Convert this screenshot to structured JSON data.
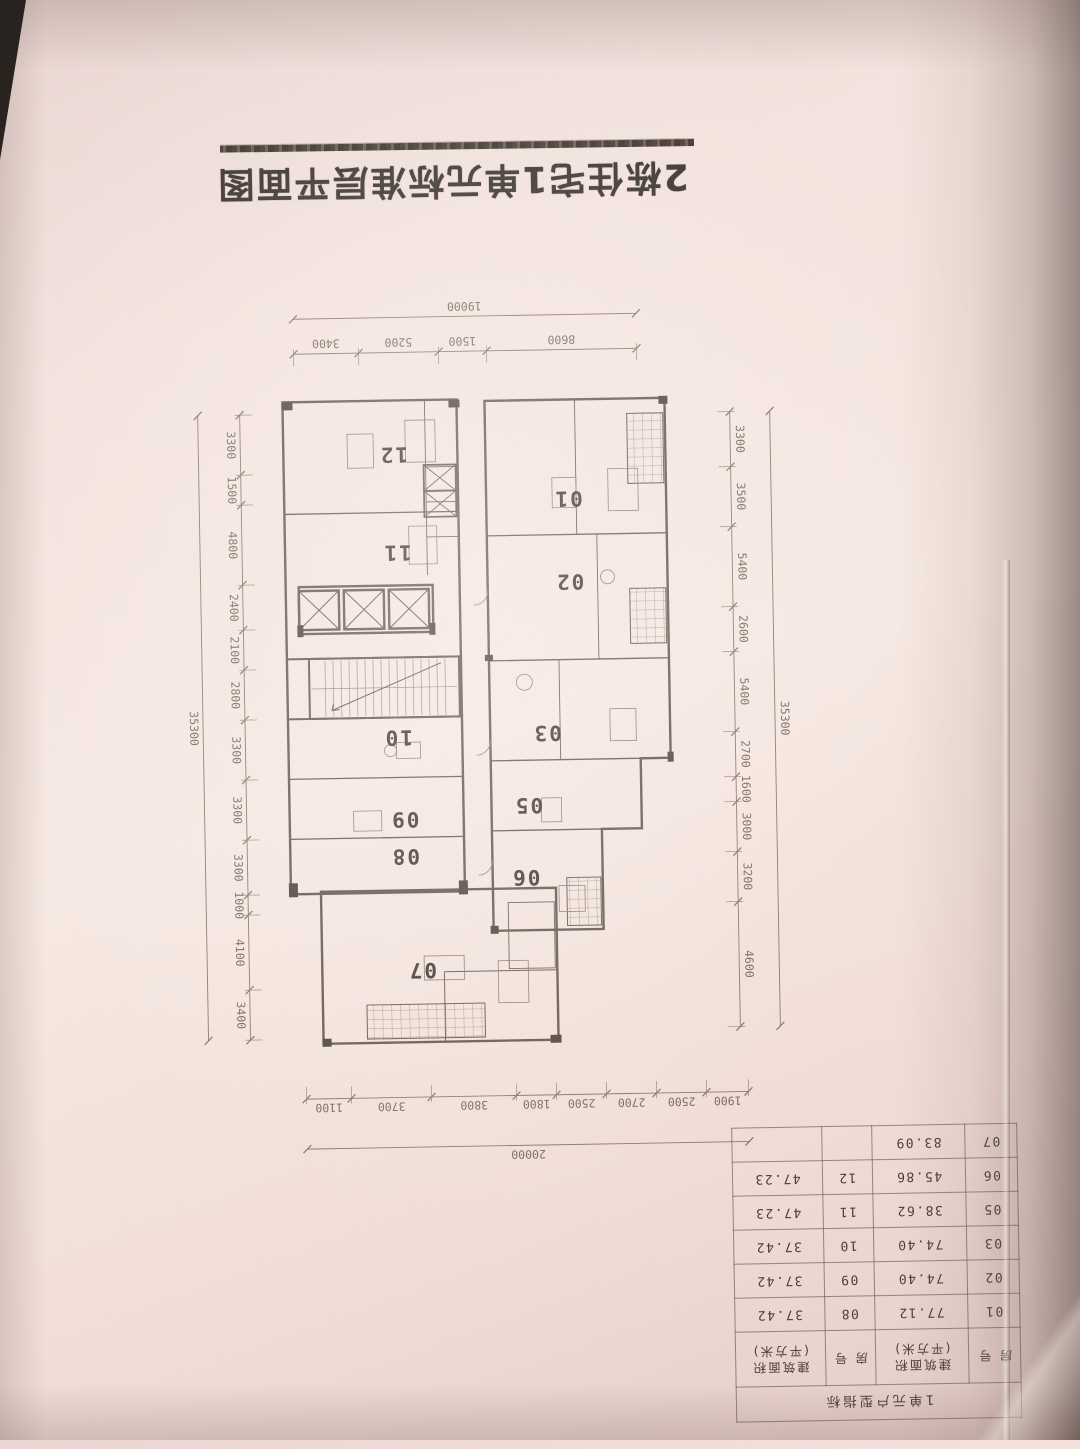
{
  "page_title": "2栋住宅1单元标准层平面图",
  "table": {
    "title": "1单元户型指标",
    "headers": [
      {
        "label": "房 号"
      },
      {
        "label": "建筑面积",
        "sub": "(平方米)"
      },
      {
        "label": "房 号"
      },
      {
        "label": "建筑面积",
        "sub": "(平方米)"
      }
    ],
    "rows": [
      [
        "01",
        "77.12",
        "08",
        "37.42"
      ],
      [
        "02",
        "74.40",
        "09",
        "37.42"
      ],
      [
        "03",
        "74.40",
        "10",
        "37.42"
      ],
      [
        "05",
        "38.62",
        "11",
        "47.23"
      ],
      [
        "06",
        "45.86",
        "12",
        "47.23"
      ],
      [
        "07",
        "83.09",
        "",
        ""
      ]
    ]
  },
  "plan": {
    "units": [
      "01",
      "02",
      "03",
      "05",
      "06",
      "07",
      "08",
      "09",
      "10",
      "11",
      "12"
    ],
    "dims": {
      "top": {
        "segments": [
          "1900",
          "2500",
          "2700",
          "2500",
          "1800",
          "3800",
          "3700",
          "1100"
        ],
        "total": "20000"
      },
      "bottom": {
        "segments": [
          "8600",
          "1500",
          "5200",
          "3400"
        ],
        "total": "19000"
      },
      "left": {
        "segments": [
          "4600",
          "3200",
          "3000",
          "1600",
          "2700",
          "5400",
          "2600",
          "5400",
          "3500",
          "3300"
        ],
        "total": "35300"
      },
      "right": {
        "segments": [
          "3400",
          "4100",
          "1000",
          "3300",
          "3300",
          "3300",
          "2800",
          "2100",
          "2400",
          "4800",
          "1500",
          "3300"
        ],
        "total": "35300"
      }
    }
  }
}
